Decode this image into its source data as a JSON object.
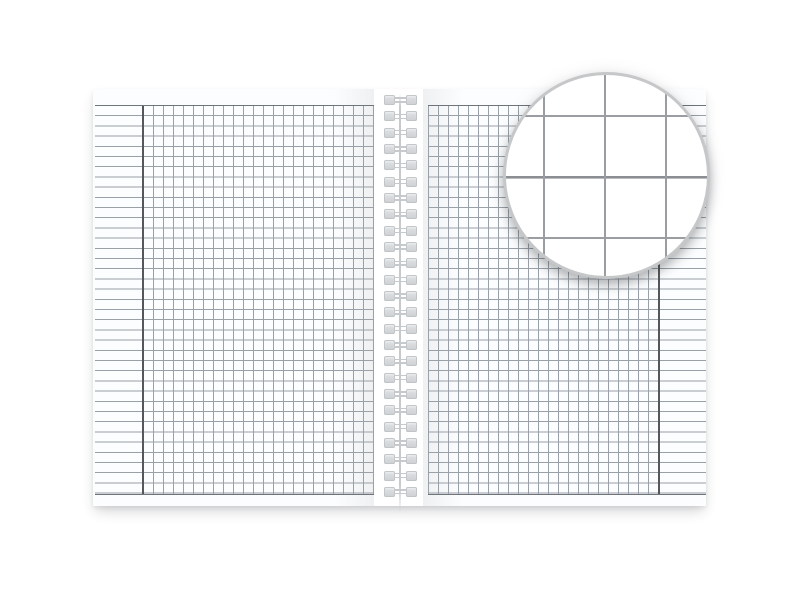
{
  "scene": {
    "description": "Open spiral-bound notebook mockup with square-grid graph paper pages, ruled margin columns, and a circular magnifier detail of the grid in the top right",
    "colors": {
      "background": "#ffffff",
      "gap": "#ffffff",
      "page": "#fcfdfe",
      "page_edge_shade": "#eef0f2",
      "grid_line": "#99a0a7",
      "rule_line": "#99a0a7",
      "boundary_line": "#6e747a",
      "margin_divider": "#54585c",
      "spiral": "#cdd0d3",
      "spiral_wire": "#c6cacc",
      "ring": "#c5c7c9",
      "mag_line": "#9a9ea2",
      "mag_line_major": "#8b8f93"
    },
    "notebook": {
      "pages": 2,
      "grid_cell_px": 10,
      "grid_columns_per_page": 23,
      "grid_rows": 38,
      "left_page_margin_side": "left",
      "right_page_margin_side": "right",
      "spiral": {
        "coil_count": 25,
        "coil_spacing_px": 16.33
      }
    },
    "magnifier": {
      "shape": "circle",
      "zoom_factor": 6,
      "magnified_cell_px": 61,
      "visible_vertical_lines": 3,
      "visible_horizontal_lines": 3
    }
  }
}
